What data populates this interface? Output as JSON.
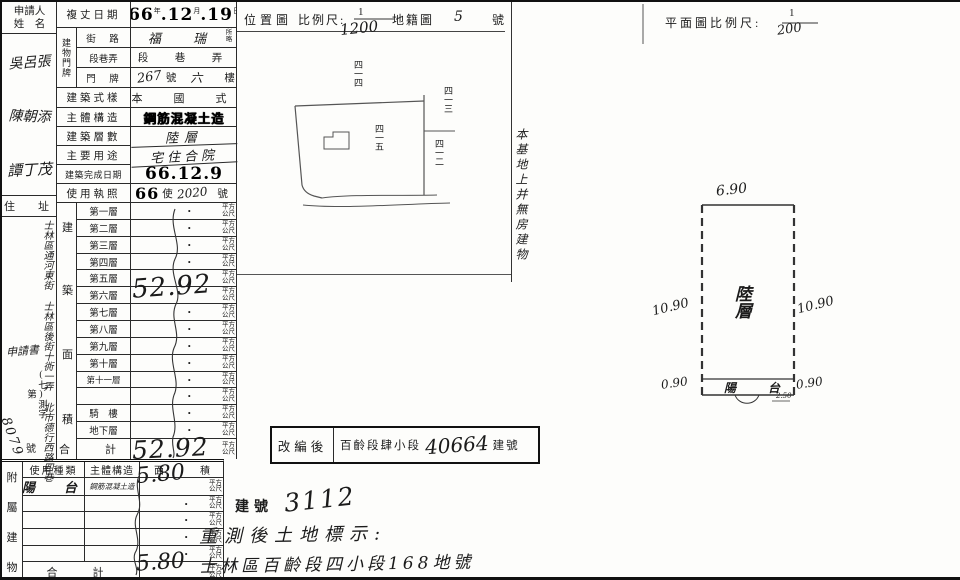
{
  "applicant": {
    "label_line1": "申請人",
    "label_line2": "姓　名",
    "names": [
      "吳呂張",
      "陳朝添",
      "譚丁茂"
    ],
    "address_label": "住　址",
    "address_cols": [
      "士林區通河東街",
      "士林區後街十衖一弄",
      "北市德行西路四巷"
    ],
    "note": "申請書",
    "file_prefix": "(七)測字第",
    "file_no": "8079",
    "file_suffix": "號"
  },
  "form": {
    "survey_date": {
      "label": "複丈日期",
      "year": "66",
      "unit_year": "年",
      "month": "12",
      "unit_month": "月",
      "day": "19",
      "unit_day": "日"
    },
    "door_group_label": "建物門牌",
    "street": {
      "label": "街　路",
      "value": "福 瑞",
      "note_top": "所",
      "note_bottom": "略"
    },
    "section": {
      "label": "段巷弄",
      "value": "段　巷　弄"
    },
    "plate": {
      "label": "門　牌",
      "no": "267",
      "no_unit": "號",
      "floor": "六",
      "floor_unit": "樓"
    },
    "style": {
      "label": "建築式樣",
      "value": "本　國　式"
    },
    "structure": {
      "label": "主體構造",
      "value": "鋼筋混凝土造"
    },
    "storeys": {
      "label": "建築層數",
      "value": "陸層"
    },
    "usage": {
      "label": "主要用途",
      "value": "宅住合院"
    },
    "completion": {
      "label": "建築完成日期",
      "value": "66.12.9"
    },
    "license": {
      "label": "使用執照",
      "year": "66",
      "mid": "使",
      "no": "2020",
      "suffix": "號"
    }
  },
  "floor_area": {
    "side_label_chars": [
      "建",
      "築",
      "面",
      "積"
    ],
    "unit_top": "平方",
    "unit_bottom": "公尺",
    "dot": "·",
    "floors": [
      {
        "label": "第一層",
        "value": ""
      },
      {
        "label": "第二層",
        "value": ""
      },
      {
        "label": "第三層",
        "value": ""
      },
      {
        "label": "第四層",
        "value": ""
      },
      {
        "label": "第五層",
        "value": ""
      },
      {
        "label": "第六層",
        "value": "52.92"
      },
      {
        "label": "第七層",
        "value": ""
      },
      {
        "label": "第八層",
        "value": ""
      },
      {
        "label": "第九層",
        "value": ""
      },
      {
        "label": "第十層",
        "value": ""
      },
      {
        "label": "第十一層",
        "value": ""
      },
      {
        "label": "",
        "value": ""
      },
      {
        "label": "騎　樓",
        "value": ""
      },
      {
        "label": "地下層",
        "value": ""
      }
    ],
    "total_label": "合　計",
    "total": "52.92"
  },
  "annex": {
    "side_label_chars": [
      "附",
      "屬",
      "建",
      "物"
    ],
    "header_use": "使用種類",
    "header_structure": "主體構造",
    "header_area_left": "面",
    "header_area_right": "積",
    "row1": {
      "use": "陽　台",
      "structure": "鋼筋混凝土造",
      "area": "5.80"
    },
    "total_label": "合　計",
    "total": "5.80"
  },
  "location_map": {
    "title": "位置圖",
    "scale_label": "比例尺:",
    "scale_num": "1",
    "scale_den": "1200",
    "cadastral_label": "地籍圖",
    "sheet_no": "5",
    "sheet_unit": "號",
    "note_vertical": "本基地上并無房建物",
    "lot_top": "四一四",
    "lot_center": "四一五",
    "lot_right_upper": "四一三",
    "lot_right_lower": "四一二"
  },
  "floor_plan": {
    "title": "平面圖比例尺:",
    "scale_num": "1",
    "scale_den": "200",
    "dim_top": "6.90",
    "dim_left": "10.90",
    "dim_right": "10.90",
    "dim_bottom_left": "0.90",
    "dim_bottom_right": "0.90",
    "dim_small": "2.50",
    "room_label": "陸層",
    "balcony_label": "陽　台"
  },
  "stamp_box": {
    "label": "改編後",
    "section": "百齡段肆小段",
    "number": "40664",
    "suffix": "建號"
  },
  "bottom_notes": {
    "building_no_label": "建號",
    "building_no": "3112",
    "line2": "重測後土地標示:",
    "line3": "士林區百齡段四小段168地號"
  }
}
